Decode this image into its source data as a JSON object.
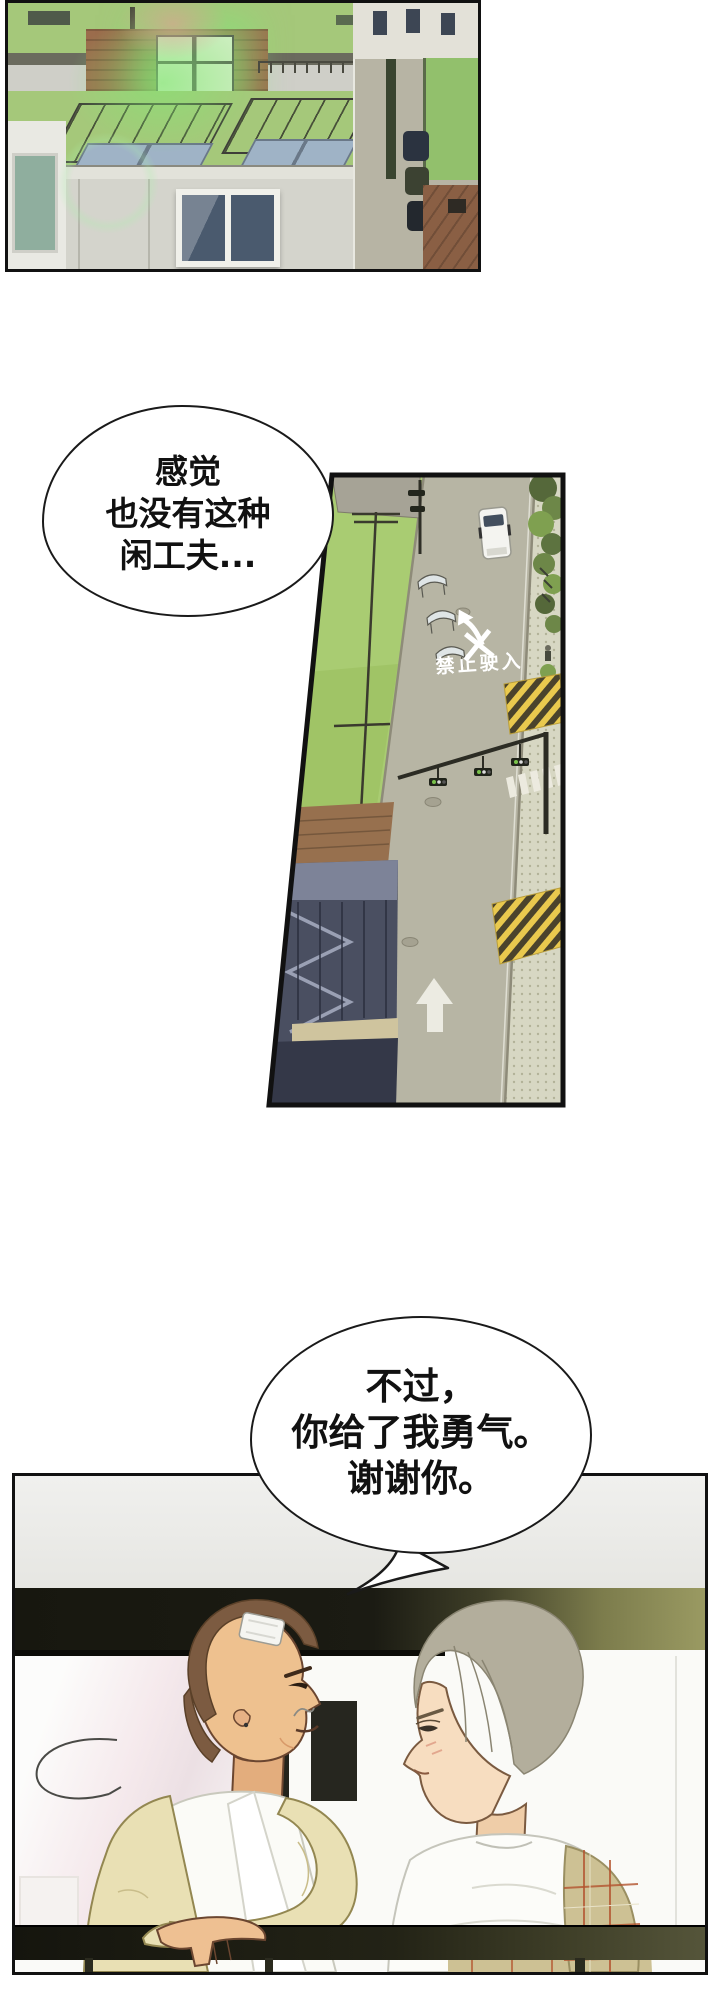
{
  "comic": {
    "bubble1": {
      "line1": "感觉",
      "line2": "也没有这种",
      "line3": "闲工夫..."
    },
    "bubble2": {
      "line1": "不过，",
      "line2": "你给了我勇气。",
      "line3": "谢谢你。"
    },
    "street_panel": {
      "road_marking_text": "禁止驶入"
    }
  },
  "colors": {
    "panel_border": "#111111",
    "roof_green": "#a9cc72",
    "road_gray": "#b7b5a4",
    "curb_yellow": "#e9c94e",
    "road_marking_white": "#ffffff",
    "cardigan_cream": "#e9e0b4",
    "plaid_coat_tan": "#cdc194",
    "plaid_line_red": "#b4542f",
    "hair_brown": "#7c5b41",
    "hair_ash_gray": "#b3ae9c",
    "glow_green": "#7ae87a"
  }
}
